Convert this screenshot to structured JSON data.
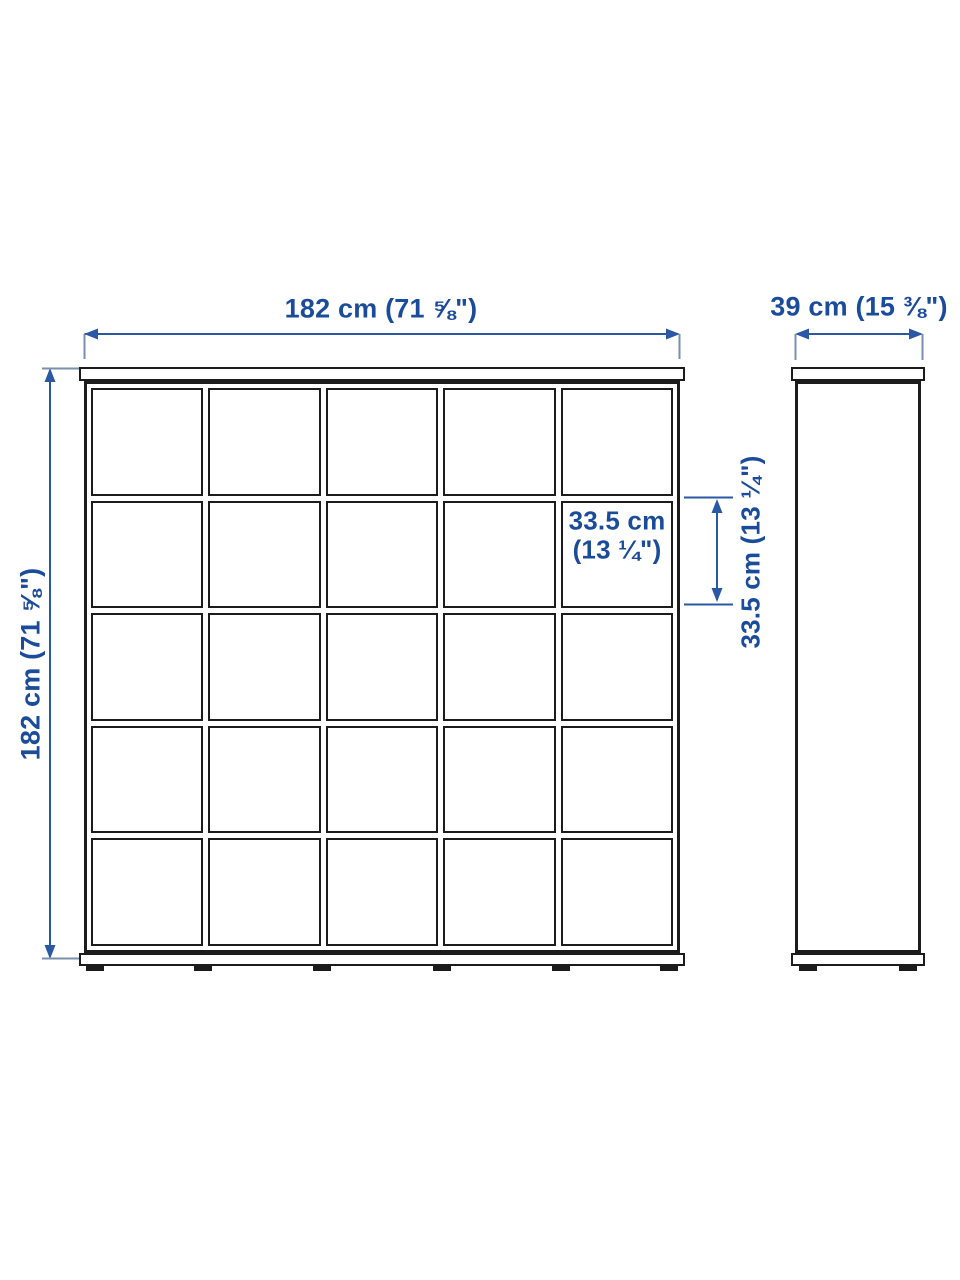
{
  "diagram": {
    "type": "product-dimension-diagram",
    "views": {
      "front": {
        "width_label": "182 cm (71 ⅝\")",
        "height_label": "182 cm (71 ⅝\")",
        "grid_rows": 5,
        "grid_cols": 5
      },
      "side": {
        "depth_label": "39 cm (15 ⅜\")"
      },
      "cell": {
        "width_label_line1": "33.5 cm",
        "width_label_line2": "(13 ¼\")",
        "height_label": "33.5 cm (13 ¼\")"
      }
    },
    "colors": {
      "outline": "#1c1c1c",
      "dimension_text": "#1b4c9b",
      "dimension_line": "#2b58a5",
      "extension_line": "#7a8fae"
    }
  }
}
